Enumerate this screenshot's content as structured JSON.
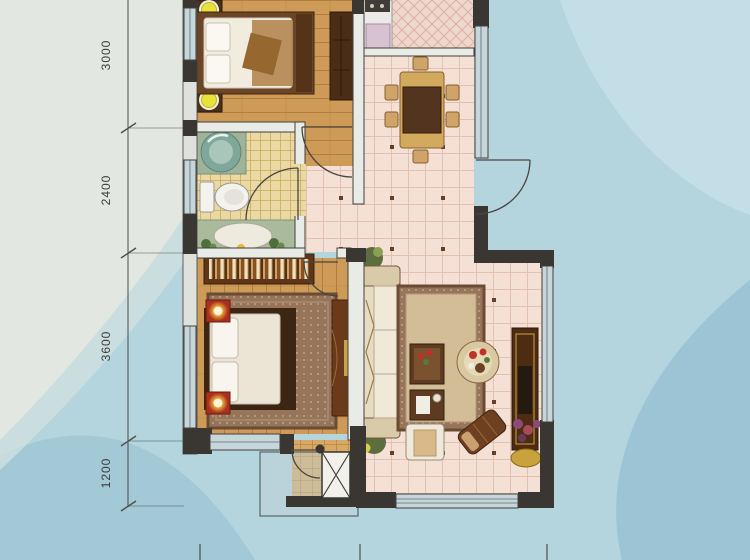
{
  "dims": [
    {
      "label": "3000"
    },
    {
      "label": "2400"
    },
    {
      "label": "3600"
    },
    {
      "label": "1200"
    }
  ],
  "plan": {
    "type": "apartment-floor-plan",
    "rooms": [
      {
        "name": "bedroom-top",
        "furniture": [
          "double-bed",
          "nightstand-lamp",
          "nightstand-lamp",
          "wardrobe"
        ]
      },
      {
        "name": "kitchen",
        "furniture": [
          "stove",
          "counter",
          "appliance"
        ]
      },
      {
        "name": "dining-area",
        "furniture": [
          "dining-table",
          "chair-x6"
        ]
      },
      {
        "name": "bathroom",
        "furniture": [
          "glass-washbasin",
          "toilet",
          "bathtub",
          "plants"
        ]
      },
      {
        "name": "hallway",
        "furniture": []
      },
      {
        "name": "master-bedroom",
        "furniture": [
          "bookshelf",
          "double-bed",
          "area-rug",
          "red-nightstand-lamp",
          "red-nightstand-lamp",
          "desk"
        ]
      },
      {
        "name": "living-room",
        "furniture": [
          "sofa",
          "plant",
          "plant",
          "area-rug",
          "coffee-table",
          "side-table",
          "round-flower-table",
          "armchair",
          "chaise",
          "tv-cabinet",
          "flower-pot",
          "gold-dish"
        ]
      },
      {
        "name": "entry-hall",
        "furniture": [
          "shaft-x-box",
          "entry-door"
        ]
      }
    ],
    "doors": [
      "bedroom-top-door",
      "bathroom-door",
      "master-bedroom-door",
      "apartment-entry-door",
      "entry-hall-door"
    ],
    "windows": [
      "left-bedroom-window",
      "left-bathroom-window",
      "left-master-window",
      "master-bottom-window",
      "living-bottom-window",
      "living-right-window",
      "dining-right-window"
    ],
    "colors": {
      "background_blue": "#b4d4de",
      "background_pale": "#e3e7e1",
      "wall_dark": "#3a3733",
      "wall_light": "#e9ebe6",
      "window_fill": "#c7d6da",
      "wood_floor": "#cd9a58",
      "bath_tile": "#ebd9a4",
      "main_tile": "#f4e0d4",
      "kitchen_tile": "#efd7ce",
      "accent_red": "#a83020",
      "lamp_yellow": "#e9e13c"
    }
  }
}
